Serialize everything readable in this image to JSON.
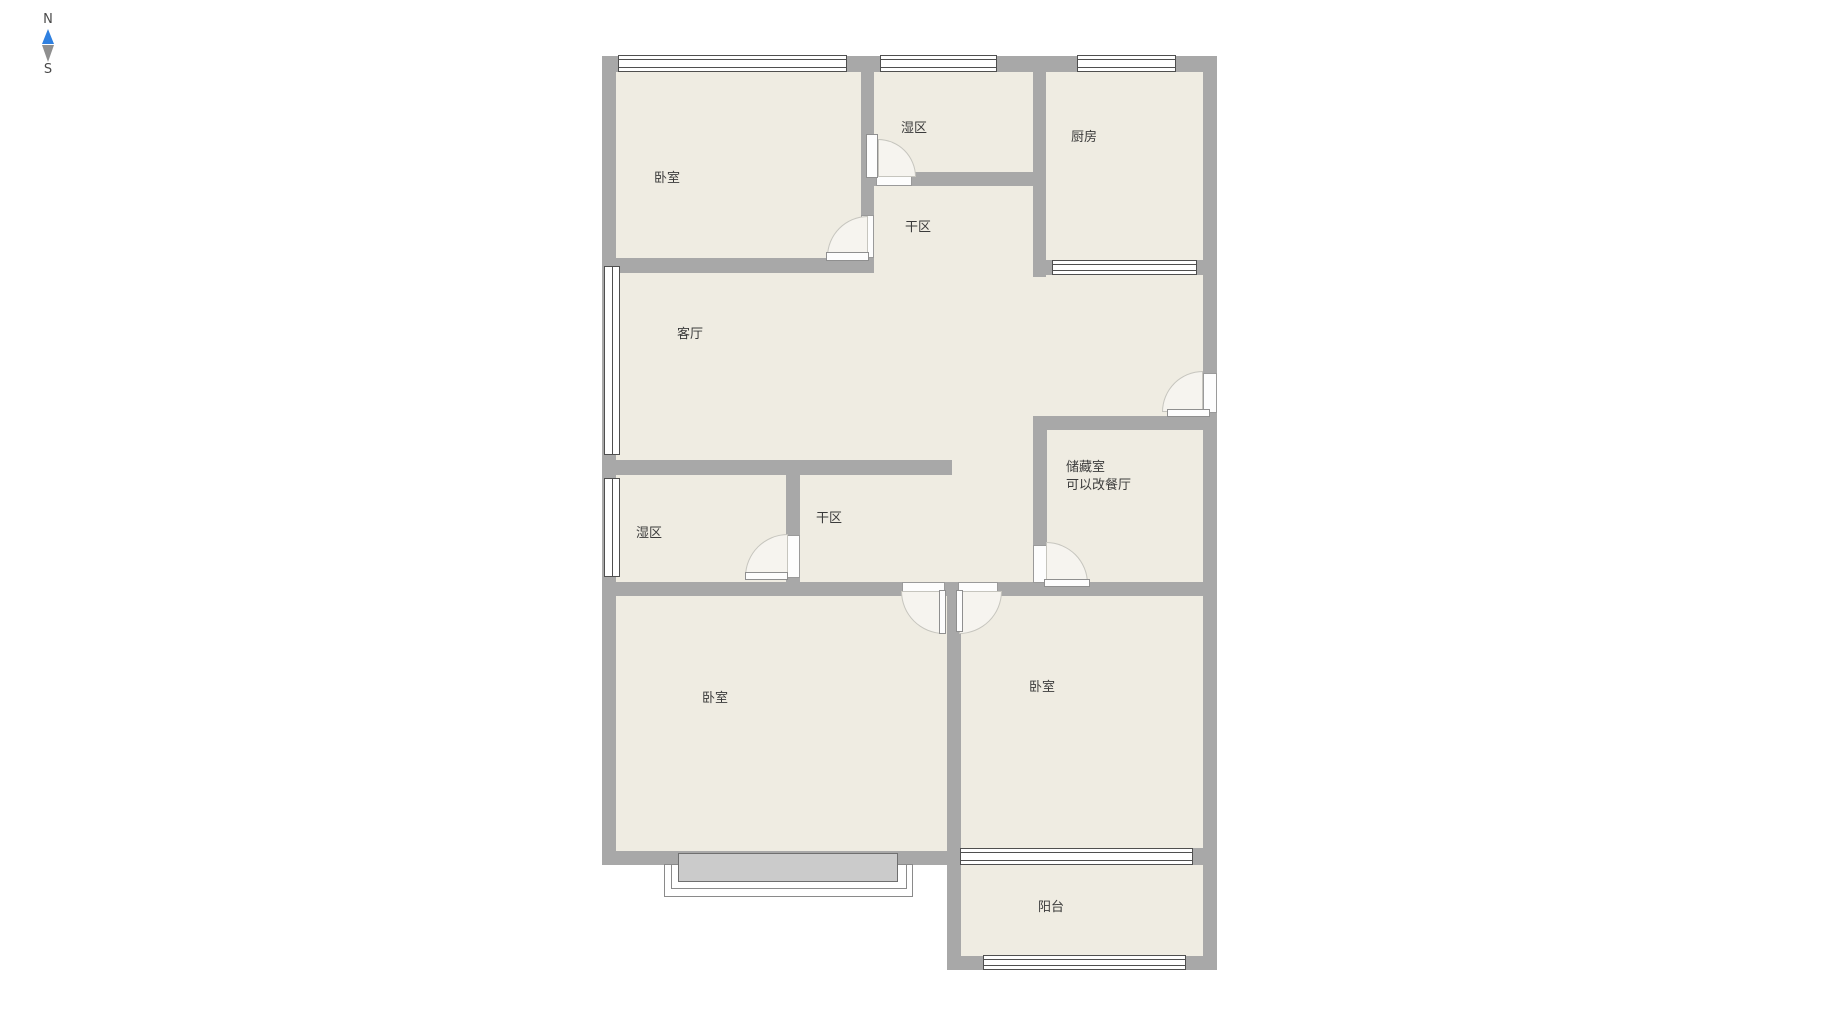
{
  "compass": {
    "north": "N",
    "south": "S"
  },
  "rooms": {
    "bedroom_top": {
      "label": "卧室"
    },
    "wet_top": {
      "label": "湿区"
    },
    "kitchen": {
      "label": "厨房"
    },
    "dry_top": {
      "label": "干区"
    },
    "living": {
      "label": "客厅"
    },
    "wet_mid": {
      "label": "湿区"
    },
    "dry_mid": {
      "label": "干区"
    },
    "storage": {
      "label": "储藏室",
      "note": "可以改餐厅"
    },
    "bedroom_left": {
      "label": "卧室"
    },
    "bedroom_right": {
      "label": "卧室"
    },
    "balcony": {
      "label": "阳台"
    }
  },
  "colors": {
    "wall": "#a8a8a8",
    "floor": "#efece2",
    "arcfill": "#f6f4ef",
    "compassblue": "#2f80e0",
    "compassgray": "#8f8f8f"
  }
}
